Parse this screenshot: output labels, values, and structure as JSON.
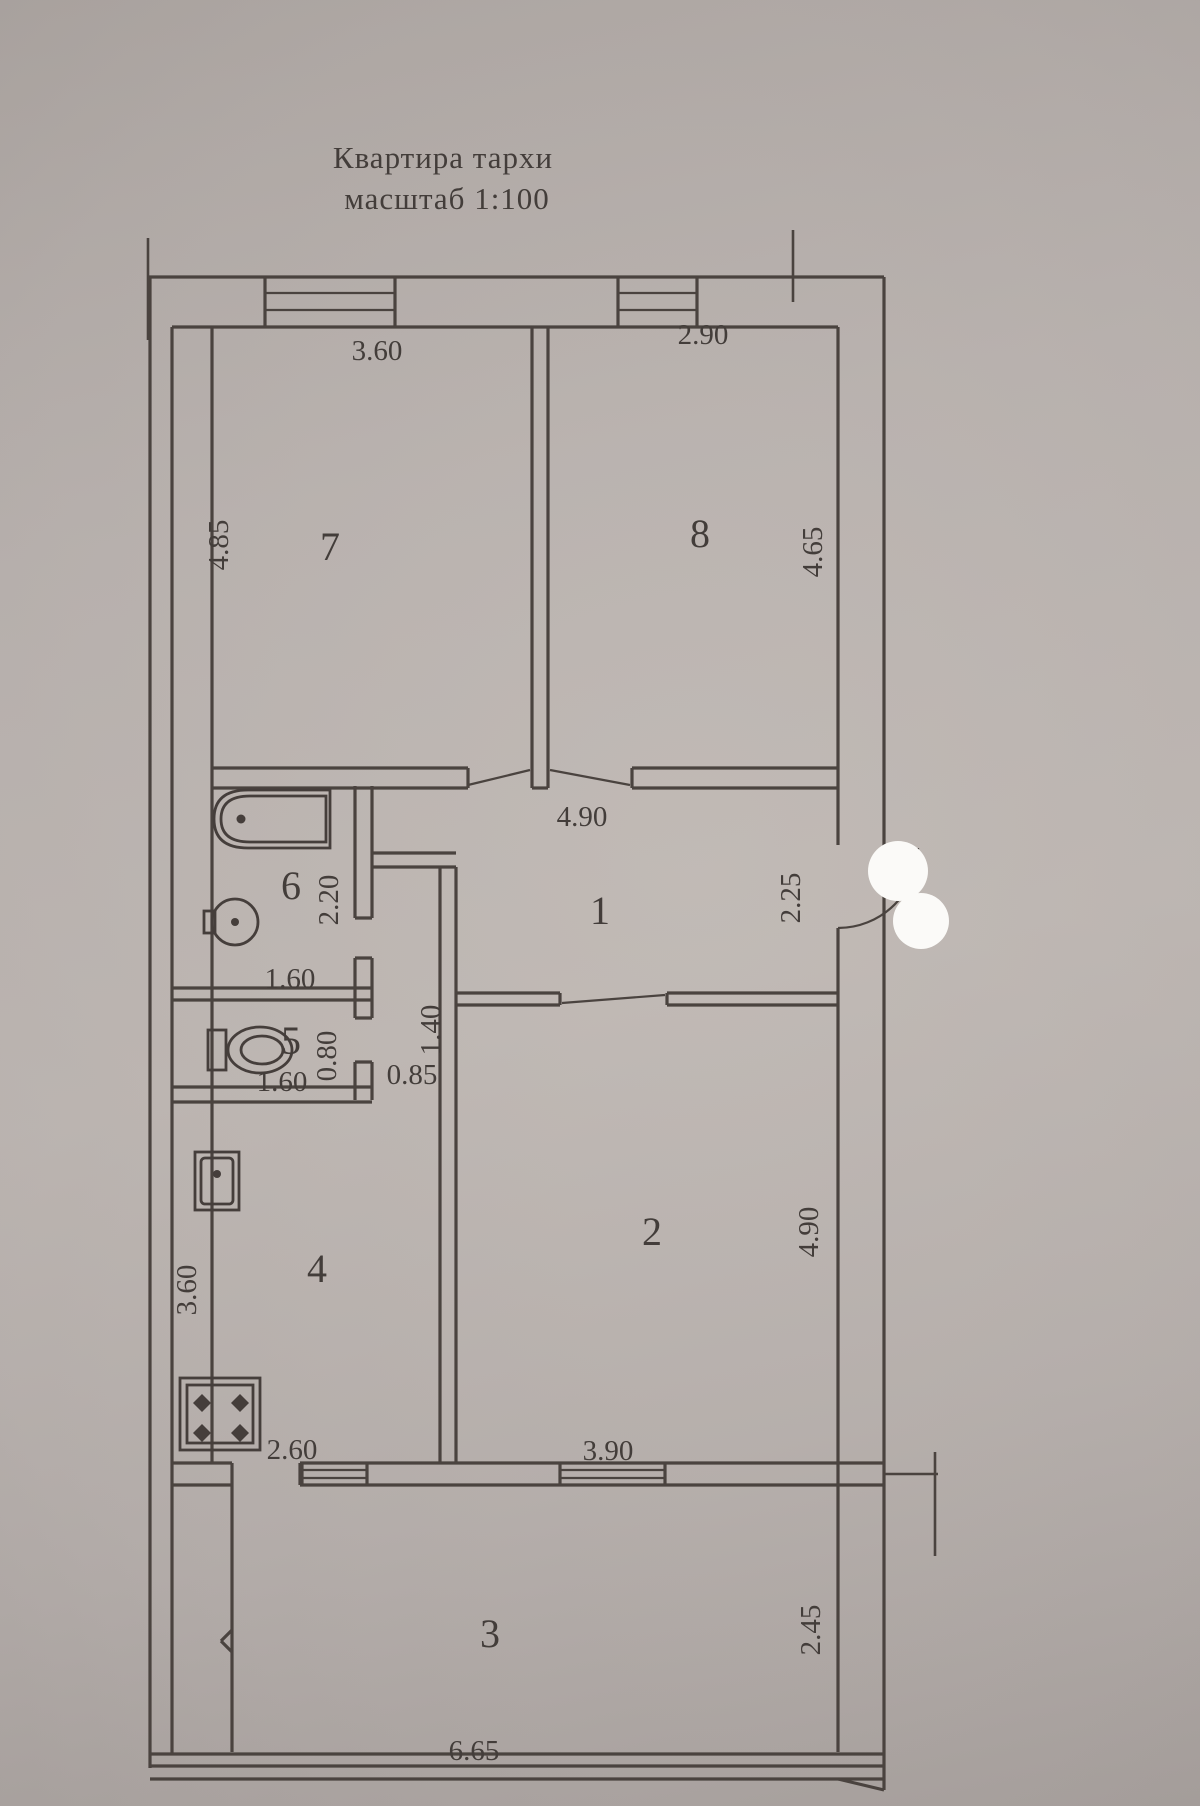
{
  "title": {
    "line1": "Квартира тархи",
    "line2": "масштаб 1:100"
  },
  "rooms": {
    "r1": {
      "number": "1"
    },
    "r2": {
      "number": "2"
    },
    "r3": {
      "number": "3"
    },
    "r4": {
      "number": "4"
    },
    "r5": {
      "number": "5"
    },
    "r6": {
      "number": "6"
    },
    "r7": {
      "number": "7"
    },
    "r8": {
      "number": "8"
    }
  },
  "dims": {
    "room7_top": "3.60",
    "room8_top": "2.90",
    "room7_left": "4.85",
    "room8_right": "4.65",
    "hall_top": "4.90",
    "hall_right": "2.25",
    "bath_right": "2.20",
    "bath_bottom": "1.60",
    "wc_right": "0.80",
    "wc_bottom": "1.60",
    "pantry_door": "0.85",
    "pantry_side": "1.40",
    "kitchen_left": "3.60",
    "kitchen_bottom": "2.60",
    "room2_bottom": "3.90",
    "room2_right": "4.90",
    "balcony_bottom": "6.65",
    "balcony_right": "2.45"
  },
  "fixtures": [
    "bathtub",
    "washbasin",
    "toilet",
    "kitchen-sink",
    "stove"
  ],
  "colors": {
    "paper": "#b4adaa",
    "ink": "#4a433f",
    "redaction": "#fbfaf8"
  }
}
